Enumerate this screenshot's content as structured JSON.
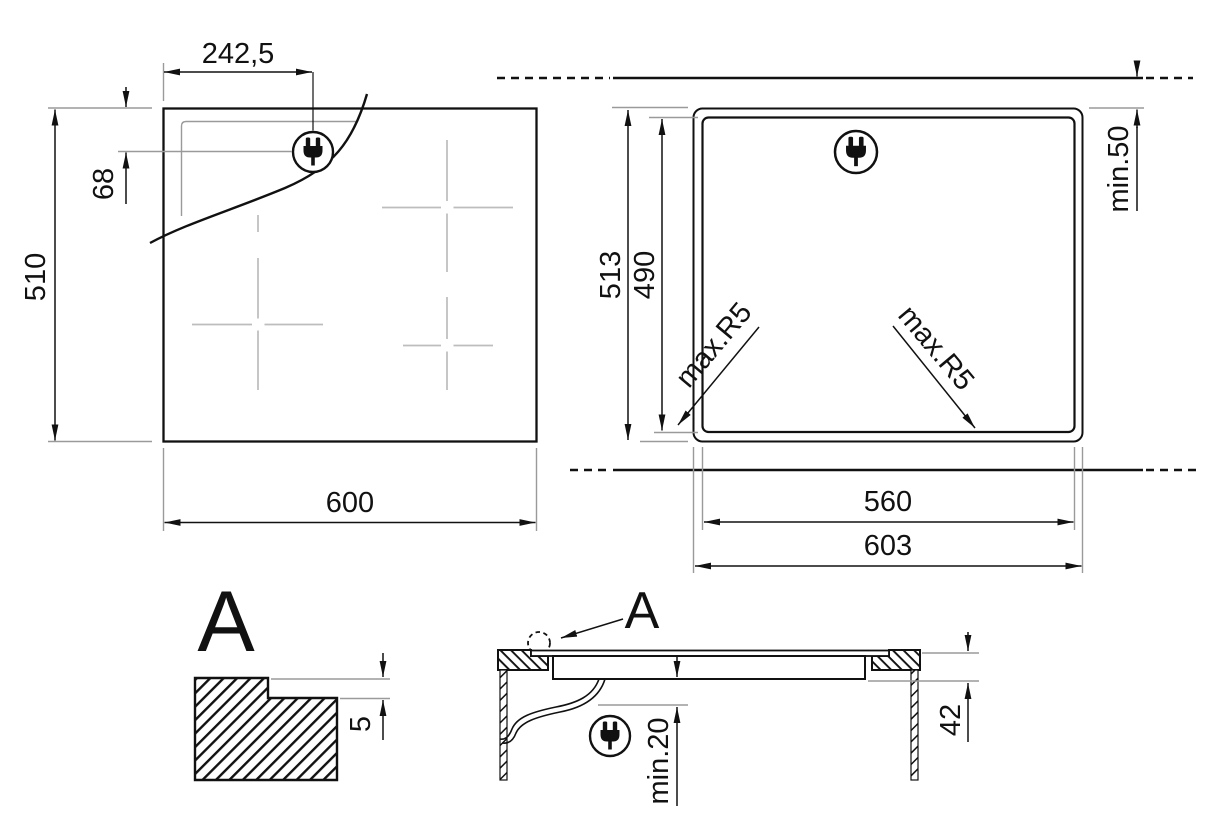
{
  "top_view": {
    "width": "600",
    "height": "510",
    "plug_offset_x": "242,5",
    "plug_offset_y": "68"
  },
  "cutout_view": {
    "outer_width": "603",
    "inner_width": "560",
    "outer_height": "513",
    "inner_height": "490",
    "rear_clearance": "min.50",
    "corner_radius_left": "max.R5",
    "corner_radius_right": "max.R5"
  },
  "detail_view": {
    "label": "A",
    "step_depth": "5"
  },
  "section_view": {
    "label": "A",
    "bottom_clearance": "min.20",
    "hob_height": "42"
  },
  "icons": {
    "plug": "power-plug"
  },
  "colors": {
    "line": "#111111",
    "extension": "#9a9a9a",
    "zone_marks": "#bdbdbd"
  }
}
